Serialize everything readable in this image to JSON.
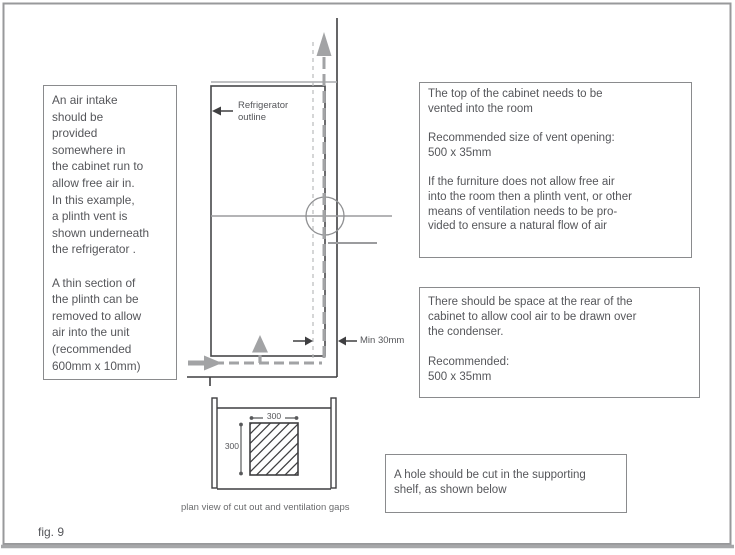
{
  "figure": {
    "label": "fig. 9"
  },
  "notes": {
    "air_intake": "An air intake\nshould be\nprovided\nsomewhere in\nthe cabinet run to\nallow free air in.\nIn this example,\na plinth vent is\nshown underneath\nthe refrigerator .\n\nA thin section of\nthe plinth can be\nremoved to allow\nair into the unit\n(recommended\n600mm x 10mm)",
    "top_vent": "The top of the cabinet needs to be\nvented into the room\n\nRecommended size of vent opening:\n500 x 35mm\n\nIf the furniture does not allow free air\ninto the room then a plinth vent,  or other\nmeans of ventilation needs to be pro-\nvided to ensure a natural flow of air",
    "rear_space": "There should be space at the rear of the\ncabinet to allow cool air to be drawn over\nthe condenser.\n\nRecommended:\n500 x 35mm",
    "shelf_hole": "A hole should be cut in the supporting\nshelf, as shown below"
  },
  "diagram": {
    "refrigerator_label": "Refrigerator\noutline",
    "min_gap_label": "Min 30mm",
    "plan_caption": "plan view of cut out and ventilation gaps",
    "cutout_width": "300",
    "cutout_height": "300"
  },
  "colors": {
    "dark_line": "#3f3f41",
    "gray_line": "#9b9c9e",
    "airflow_gray": "#a2a3a5",
    "light_dash": "#b9babc",
    "box_border": "#8a8b8d",
    "text": "#55565a",
    "page_border": "#98999b"
  }
}
